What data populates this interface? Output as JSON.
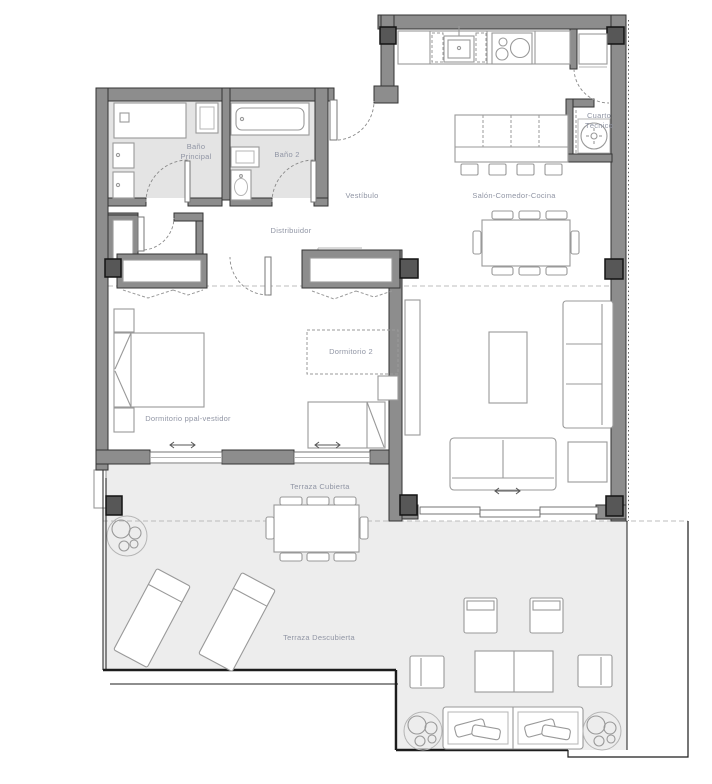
{
  "palette": {
    "wall_fill": "#8d8d8d",
    "wall_stroke": "#333333",
    "column_fill": "#575757",
    "bath_floor": "#e4e4e4",
    "terrace_floor": "#ededed",
    "furniture_stroke": "#999999",
    "label_color": "#9095a4"
  },
  "rooms": {
    "bano_principal": {
      "line1": "Baño",
      "line2": "Principal"
    },
    "bano_2": {
      "label": "Baño 2"
    },
    "vestibulo": {
      "label": "Vestíbulo"
    },
    "salon": {
      "label": "Salón-Comedor-Cocina"
    },
    "cuarto_tecnico": {
      "line1": "Cuarto",
      "line2": "Técnico"
    },
    "distribuidor": {
      "label": "Distribuidor"
    },
    "dormitorio_2": {
      "label": "Dormitorio 2"
    },
    "dormitorio_ppal": {
      "label": "Dormitorio ppal-vestidor"
    },
    "terraza_cubierta": {
      "label": "Terraza Cubierta"
    },
    "terraza_descubierta": {
      "label": "Terraza Descubierta"
    }
  }
}
